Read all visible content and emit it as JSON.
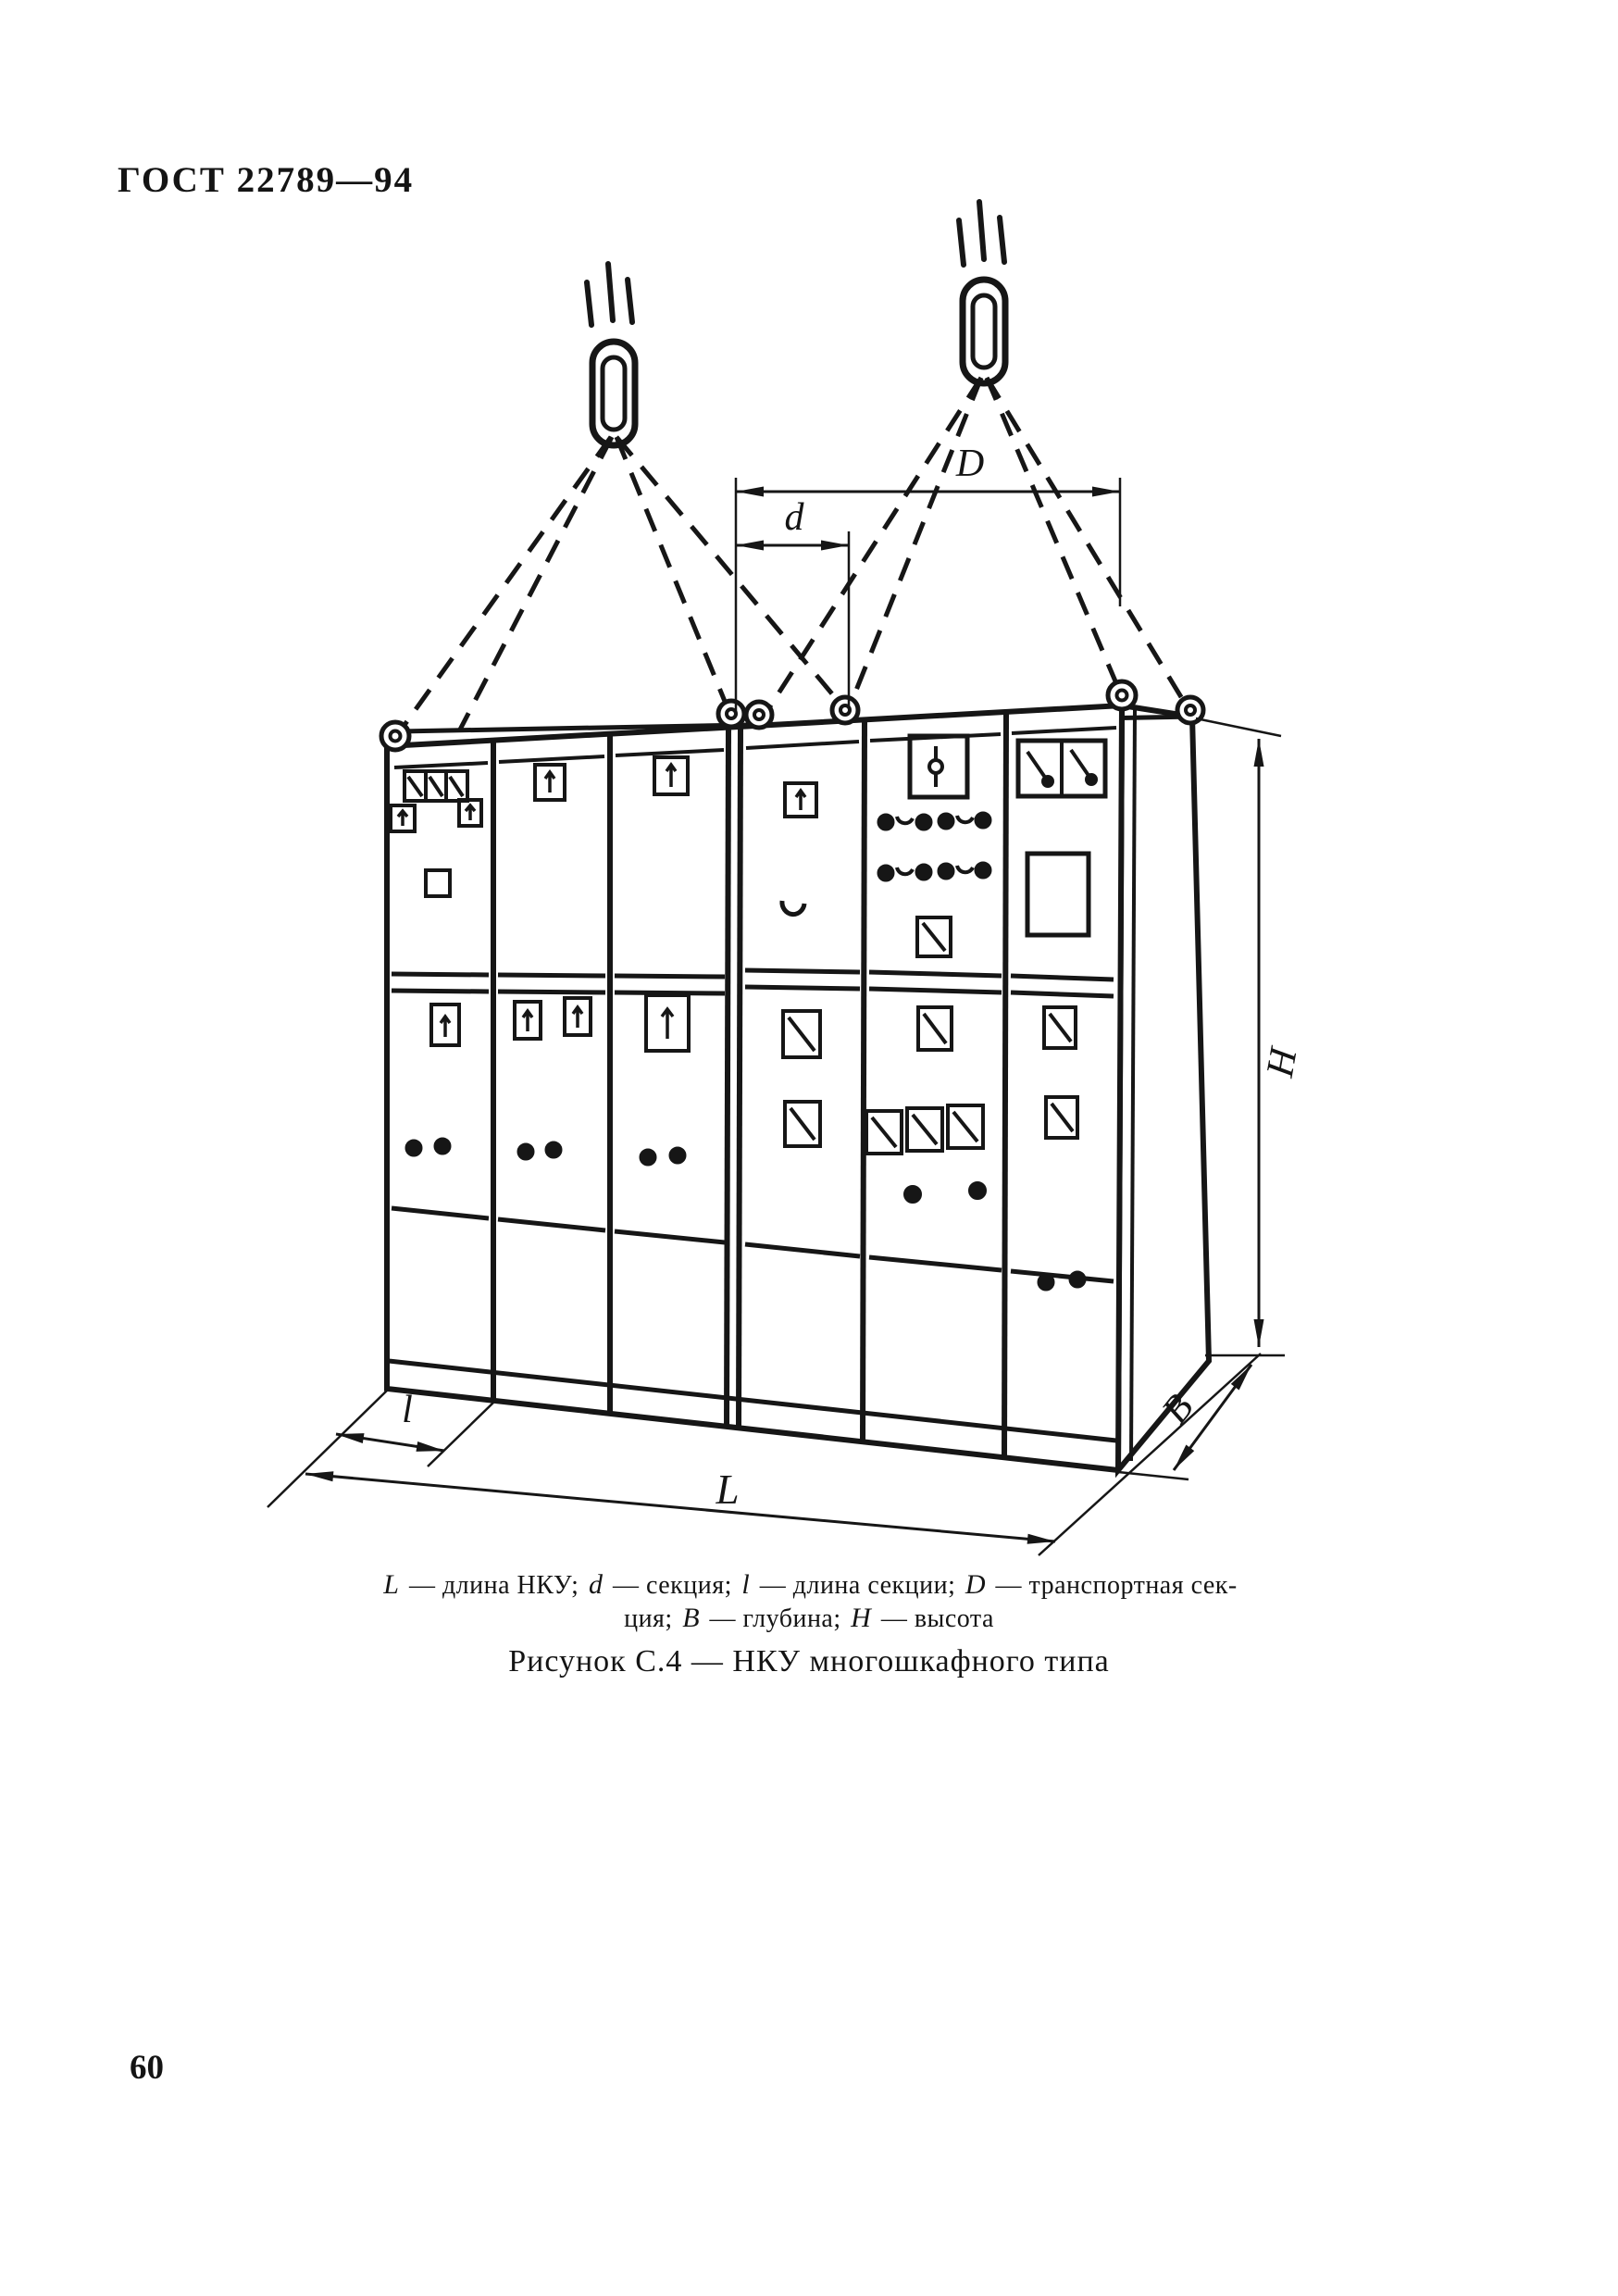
{
  "doc": {
    "header": "ГОСТ 22789—94",
    "page_number": "60"
  },
  "figure": {
    "label": "Рисунок С.4 — НКУ многошкафного типа",
    "dimensions": {
      "total_length": "L",
      "section": "d",
      "section_length": "l",
      "transport_section": "D",
      "depth": "В",
      "height": "Н"
    },
    "caption_segments": [
      {
        "i": "L"
      },
      {
        "t": " — длина НКУ; "
      },
      {
        "i": "d"
      },
      {
        "t": " — секция; "
      },
      {
        "i": "l"
      },
      {
        "t": " — длина секции; "
      },
      {
        "i": "D"
      },
      {
        "t": " — транспортная сек-"
      },
      {
        "br": true
      },
      {
        "t": "ция; "
      },
      {
        "i": "В"
      },
      {
        "t": " — глубина; "
      },
      {
        "i": "Н"
      },
      {
        "t": " — высота"
      }
    ]
  }
}
